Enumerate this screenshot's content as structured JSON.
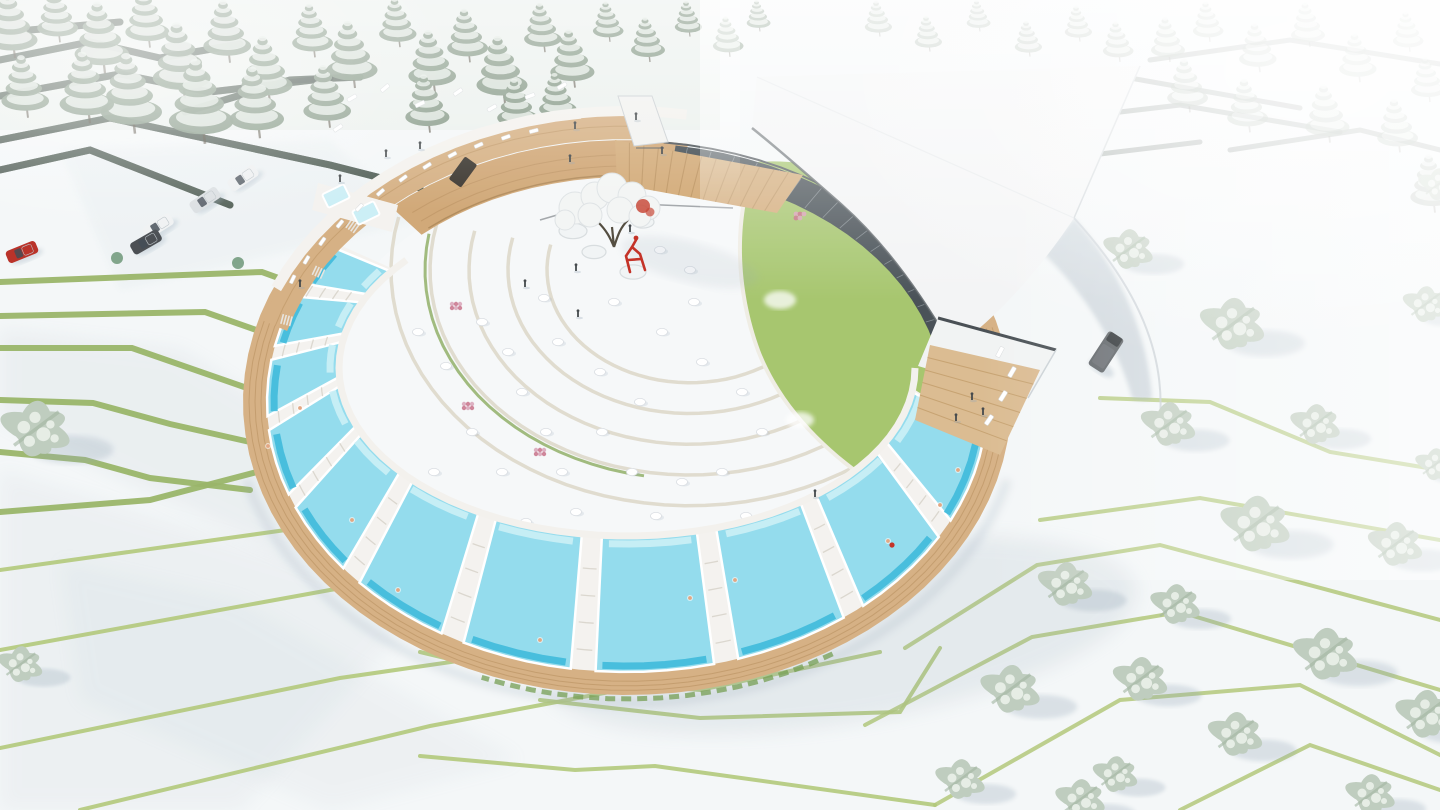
{
  "scene": {
    "type": "architectural-aerial-render",
    "subject": "circular timber spa resort with a ring of outdoor pools around a snowy courtyard",
    "setting": "snow-covered alpine clearing surrounded by pine forest with terraced hedges",
    "weather": "overcast winter haze, fresh snow"
  },
  "palette": {
    "snow": "#f4f7f8",
    "snow2": "#eaf0f2",
    "shadow": "#8fa3b4",
    "fog": "#ffffff",
    "forest": "#7e937f",
    "forest_snow": "#e3ebe4",
    "trunk": "#4a4336",
    "hedge_dark": "#45544a",
    "hedge_green": "#93b161",
    "hedge_light": "#aec573",
    "grass": "#a2c367",
    "grass_dark": "#6d9a49",
    "bush_teal": "#5d8b68",
    "pink": "#c2607a",
    "pink_light": "#d59ab0",
    "wood": "#d4ad7e",
    "wood_dark": "#b98f5c",
    "wood_deep": "#9a7443",
    "wood_light": "#e7cda3",
    "deck": "#f4f2ee",
    "white": "#fbfcfc",
    "water_deep": "#2fb4d8",
    "water": "#8edaec",
    "water_pale": "#c9eef6",
    "glazing": "#3f484e",
    "eave": "#474e53",
    "roof": "#f3f4f5",
    "roof_edge": "#c9d0d4",
    "red": "#c1271b",
    "skin": "#e2a27c",
    "person": "#3a3f42",
    "tree_pale": "#bccabb",
    "tree_pale_dark": "#9db29d",
    "tree_snow": "#e9efe9",
    "planter": "#d6dbde"
  },
  "ring": {
    "cx": 627,
    "cy": 402,
    "outer_rx": 384,
    "outer_ry": 293,
    "wood_inner_rx": 358,
    "wood_inner_ry": 268,
    "pool_outer_rx": 360,
    "pool_outer_ry": 270,
    "pool_inner_cx": 627,
    "pool_inner_cy": 368,
    "pool_inner_rx": 288,
    "pool_inner_ry": 168,
    "floor_rx": 310,
    "floor_ry": 228,
    "amphitheater": {
      "cx": 690,
      "cy": 270,
      "rx": 260,
      "ry": 205,
      "fractions": [
        0.55,
        0.7,
        0.85,
        1.0,
        1.15
      ],
      "a1": 40,
      "a2": 193
    }
  },
  "pools": {
    "segments": [
      [
        8,
        26
      ],
      [
        30,
        49
      ],
      [
        53,
        72
      ],
      [
        76,
        95
      ],
      [
        99,
        117
      ],
      [
        121,
        138
      ],
      [
        142,
        157
      ],
      [
        160,
        174
      ],
      [
        177,
        189
      ],
      [
        192,
        203
      ],
      [
        206,
        215
      ]
    ]
  },
  "swimmers": [
    [
      300,
      408
    ],
    [
      268,
      446
    ],
    [
      352,
      520
    ],
    [
      398,
      590
    ],
    [
      540,
      640
    ],
    [
      690,
      598
    ],
    [
      735,
      580
    ],
    [
      888,
      541
    ],
    [
      940,
      505
    ],
    [
      958,
      470
    ]
  ],
  "red_float": [
    892,
    545
  ],
  "hot_tubs": [
    [
      336,
      196
    ],
    [
      366,
      213
    ]
  ],
  "cars": [
    {
      "x": 243,
      "y": 178,
      "rot": -34,
      "color": "#eef0f1"
    },
    {
      "x": 205,
      "y": 200,
      "rot": -34,
      "color": "#d9dee1"
    },
    {
      "x": 158,
      "y": 226,
      "rot": -32,
      "color": "#f0f2f3"
    },
    {
      "x": 146,
      "y": 242,
      "rot": -30,
      "color": "#41464a"
    },
    {
      "x": 22,
      "y": 252,
      "rot": -22,
      "color": "#b6271d"
    }
  ],
  "van": {
    "x": 1106,
    "y": 352,
    "rot": 33
  },
  "parking_bushes": [
    [
      117,
      258
    ],
    [
      238,
      263
    ]
  ],
  "plaza": {
    "tree": {
      "x": 614,
      "y": 247
    },
    "planters": [
      [
        573,
        231,
        14
      ],
      [
        594,
        252,
        12
      ],
      [
        633,
        272,
        13
      ],
      [
        643,
        222,
        11
      ]
    ],
    "benches": [
      [
        540,
        220,
        588,
        206
      ],
      [
        638,
        204,
        733,
        208
      ]
    ],
    "sculpture": {
      "x": 634,
      "y": 258
    },
    "people": [
      [
        570,
        162
      ],
      [
        662,
        154
      ],
      [
        630,
        232
      ],
      [
        576,
        271
      ],
      [
        578,
        317
      ],
      [
        525,
        287
      ],
      [
        300,
        287
      ],
      [
        815,
        497
      ]
    ]
  },
  "roof_people": [
    [
      386,
      157
    ],
    [
      420,
      149
    ],
    [
      575,
      129
    ],
    [
      636,
      120
    ],
    [
      340,
      182
    ]
  ],
  "deck_people": [
    [
      972,
      400
    ],
    [
      983,
      415
    ],
    [
      956,
      421
    ]
  ],
  "lounger_angles": [
    206,
    210.5,
    215,
    219.5,
    224,
    228.5,
    233,
    237.5,
    242,
    246.5,
    251,
    255.5
  ],
  "snow_loungers": [
    [
      352,
      98,
      -30
    ],
    [
      385,
      88,
      -40
    ],
    [
      420,
      104,
      -25
    ],
    [
      458,
      92,
      -35
    ],
    [
      492,
      108,
      -30
    ],
    [
      530,
      96,
      -20
    ],
    [
      338,
      128,
      -35
    ],
    [
      562,
      86,
      -30
    ]
  ],
  "deck_loungers": [
    [
      1000,
      352,
      -62
    ],
    [
      1012,
      372,
      -60
    ],
    [
      1003,
      396,
      -58
    ],
    [
      989,
      420,
      -55
    ]
  ],
  "shrubs": [
    [
      418,
      332
    ],
    [
      446,
      366
    ],
    [
      482,
      322
    ],
    [
      508,
      352
    ],
    [
      522,
      392
    ],
    [
      472,
      432
    ],
    [
      434,
      472
    ],
    [
      502,
      472
    ],
    [
      546,
      432
    ],
    [
      562,
      472
    ],
    [
      602,
      432
    ],
    [
      632,
      472
    ],
    [
      576,
      512
    ],
    [
      526,
      522
    ],
    [
      612,
      542
    ],
    [
      656,
      516
    ],
    [
      702,
      542
    ],
    [
      682,
      482
    ],
    [
      722,
      472
    ],
    [
      746,
      516
    ],
    [
      700,
      582
    ],
    [
      642,
      592
    ],
    [
      584,
      582
    ],
    [
      662,
      332
    ],
    [
      702,
      362
    ],
    [
      742,
      392
    ],
    [
      694,
      302
    ],
    [
      762,
      432
    ],
    [
      558,
      342
    ],
    [
      600,
      372
    ],
    [
      640,
      402
    ],
    [
      614,
      302
    ],
    [
      544,
      298
    ],
    [
      660,
      250
    ],
    [
      690,
      270
    ],
    [
      760,
      560
    ]
  ],
  "pink_shrubs": [
    [
      456,
      306
    ],
    [
      468,
      406
    ],
    [
      540,
      452
    ]
  ],
  "grass_patches": {
    "bushes_dark": [
      [
        806,
        192
      ],
      [
        852,
        208
      ],
      [
        902,
        258
      ],
      [
        934,
        306
      ],
      [
        948,
        358
      ],
      [
        940,
        412
      ],
      [
        908,
        462
      ],
      [
        864,
        480
      ]
    ],
    "bushes_teal": [
      [
        860,
        200
      ],
      [
        946,
        302
      ],
      [
        926,
        452
      ]
    ],
    "bushes_pink": [
      [
        816,
        190
      ],
      [
        800,
        216
      ],
      [
        936,
        298
      ],
      [
        952,
        362
      ],
      [
        930,
        478
      ],
      [
        868,
        492
      ]
    ]
  },
  "hedges": {
    "dark_topleft": [
      [
        [
          0,
          60
        ],
        [
          90,
          42
        ],
        [
          160,
          58
        ],
        [
          240,
          44
        ]
      ],
      [
        [
          0,
          96
        ],
        [
          120,
          74
        ],
        [
          210,
          92
        ],
        [
          330,
          78
        ]
      ],
      [
        [
          0,
          140
        ],
        [
          110,
          118
        ],
        [
          330,
          165
        ],
        [
          420,
          188
        ]
      ],
      [
        [
          30,
          30
        ],
        [
          120,
          22
        ]
      ],
      [
        [
          185,
          112
        ],
        [
          290,
          80
        ],
        [
          360,
          77
        ]
      ],
      [
        [
          0,
          170
        ],
        [
          90,
          150
        ],
        [
          230,
          205
        ]
      ]
    ],
    "dark_topright": [
      [
        [
          955,
          95
        ],
        [
          1130,
          78
        ],
        [
          1300,
          108
        ]
      ],
      [
        [
          1000,
          126
        ],
        [
          1180,
          105
        ],
        [
          1340,
          132
        ]
      ],
      [
        [
          1150,
          60
        ],
        [
          1290,
          40
        ],
        [
          1440,
          64
        ]
      ],
      [
        [
          1230,
          150
        ],
        [
          1360,
          130
        ],
        [
          1440,
          150
        ]
      ],
      [
        [
          1050,
          160
        ],
        [
          1200,
          142
        ]
      ]
    ],
    "green_left": [
      [
        [
          0,
          282
        ],
        [
          262,
          272
        ],
        [
          295,
          284
        ]
      ],
      [
        [
          0,
          316
        ],
        [
          205,
          312
        ],
        [
          262,
          332
        ]
      ],
      [
        [
          0,
          348
        ],
        [
          132,
          348
        ],
        [
          247,
          388
        ]
      ],
      [
        [
          0,
          400
        ],
        [
          93,
          403
        ],
        [
          170,
          424
        ],
        [
          250,
          442
        ]
      ],
      [
        [
          0,
          452
        ],
        [
          85,
          460
        ],
        [
          150,
          478
        ],
        [
          250,
          490
        ]
      ],
      [
        [
          0,
          512
        ],
        [
          150,
          500
        ],
        [
          295,
          462
        ]
      ]
    ],
    "green_bottom_left": [
      [
        [
          0,
          570
        ],
        [
          300,
          528
        ],
        [
          420,
          510
        ]
      ],
      [
        [
          0,
          650
        ],
        [
          330,
          590
        ],
        [
          540,
          556
        ]
      ],
      [
        [
          0,
          748
        ],
        [
          340,
          678
        ],
        [
          520,
          652
        ],
        [
          700,
          640
        ]
      ],
      [
        [
          80,
          810
        ],
        [
          430,
          726
        ],
        [
          620,
          690
        ],
        [
          760,
          652
        ]
      ],
      [
        [
          420,
          652
        ],
        [
          520,
          676
        ],
        [
          700,
          690
        ],
        [
          880,
          652
        ]
      ],
      [
        [
          540,
          700
        ],
        [
          700,
          718
        ],
        [
          900,
          712
        ],
        [
          940,
          648
        ]
      ],
      [
        [
          420,
          756
        ],
        [
          575,
          770
        ],
        [
          655,
          766
        ],
        [
          935,
          805
        ]
      ]
    ],
    "green_bottom_right": [
      [
        [
          905,
          648
        ],
        [
          1037,
          565
        ],
        [
          1160,
          545
        ],
        [
          1440,
          620
        ]
      ],
      [
        [
          865,
          725
        ],
        [
          1032,
          637
        ],
        [
          1180,
          612
        ],
        [
          1440,
          690
        ]
      ],
      [
        [
          935,
          805
        ],
        [
          1120,
          700
        ],
        [
          1300,
          685
        ],
        [
          1440,
          755
        ]
      ],
      [
        [
          1180,
          810
        ],
        [
          1310,
          745
        ],
        [
          1440,
          790
        ]
      ],
      [
        [
          1040,
          520
        ],
        [
          1200,
          498
        ],
        [
          1440,
          540
        ]
      ],
      [
        [
          1100,
          398
        ],
        [
          1210,
          402
        ],
        [
          1330,
          452
        ],
        [
          1440,
          470
        ]
      ]
    ]
  },
  "trees": {
    "top": [
      [
        15,
        55,
        1.5
      ],
      [
        60,
        40,
        1.2
      ],
      [
        105,
        70,
        1.6
      ],
      [
        150,
        45,
        1.3
      ],
      [
        185,
        95,
        1.7
      ],
      [
        230,
        60,
        1.4
      ],
      [
        270,
        100,
        1.5
      ],
      [
        315,
        55,
        1.2
      ],
      [
        355,
        85,
        1.5
      ],
      [
        400,
        45,
        1.1
      ],
      [
        435,
        90,
        1.4
      ],
      [
        470,
        60,
        1.2
      ],
      [
        505,
        100,
        1.5
      ],
      [
        545,
        50,
        1.1
      ],
      [
        575,
        85,
        1.3
      ],
      [
        135,
        130,
        1.8
      ],
      [
        205,
        140,
        1.9
      ],
      [
        90,
        120,
        1.6
      ],
      [
        28,
        115,
        1.4
      ],
      [
        260,
        135,
        1.6
      ],
      [
        330,
        125,
        1.4
      ],
      [
        430,
        130,
        1.3
      ],
      [
        520,
        130,
        1.2
      ],
      [
        560,
        120,
        1.1
      ],
      [
        610,
        40,
        0.9
      ],
      [
        650,
        60,
        1.0
      ],
      [
        690,
        35,
        0.8
      ],
      [
        730,
        55,
        0.9
      ],
      [
        760,
        30,
        0.7
      ]
    ],
    "top_far": [
      [
        880,
        35,
        0.8
      ],
      [
        930,
        50,
        0.8
      ],
      [
        980,
        30,
        0.7
      ],
      [
        1030,
        55,
        0.8
      ],
      [
        1080,
        40,
        0.8
      ],
      [
        1120,
        60,
        0.9
      ],
      [
        1170,
        60,
        1.0
      ],
      [
        1210,
        40,
        0.9
      ],
      [
        1260,
        70,
        1.1
      ],
      [
        1310,
        45,
        1.0
      ],
      [
        1360,
        80,
        1.1
      ],
      [
        1410,
        50,
        0.9
      ],
      [
        1430,
        100,
        1.0
      ],
      [
        1190,
        110,
        1.2
      ],
      [
        1250,
        130,
        1.2
      ],
      [
        1330,
        140,
        1.3
      ],
      [
        1400,
        150,
        1.2
      ],
      [
        1435,
        210,
        1.3
      ]
    ],
    "right": [
      [
        1128,
        250,
        1.0
      ],
      [
        1232,
        325,
        1.3
      ],
      [
        1168,
        425,
        1.1
      ],
      [
        1315,
        425,
        1.0
      ],
      [
        1255,
        525,
        1.4
      ],
      [
        1395,
        545,
        1.1
      ],
      [
        1175,
        605,
        1.0
      ],
      [
        1325,
        655,
        1.3
      ],
      [
        1425,
        715,
        1.2
      ],
      [
        1235,
        735,
        1.1
      ],
      [
        1115,
        775,
        0.9
      ],
      [
        1370,
        795,
        1.0
      ],
      [
        1435,
        465,
        0.8
      ],
      [
        1425,
        305,
        0.9
      ],
      [
        1438,
        185,
        0.8
      ],
      [
        1065,
        585,
        1.1
      ],
      [
        1010,
        690,
        1.2
      ],
      [
        1140,
        680,
        1.1
      ],
      [
        960,
        780,
        1.0
      ],
      [
        1080,
        800,
        1.0
      ]
    ],
    "left": [
      [
        35,
        430,
        1.4
      ],
      [
        20,
        665,
        0.9
      ]
    ]
  }
}
